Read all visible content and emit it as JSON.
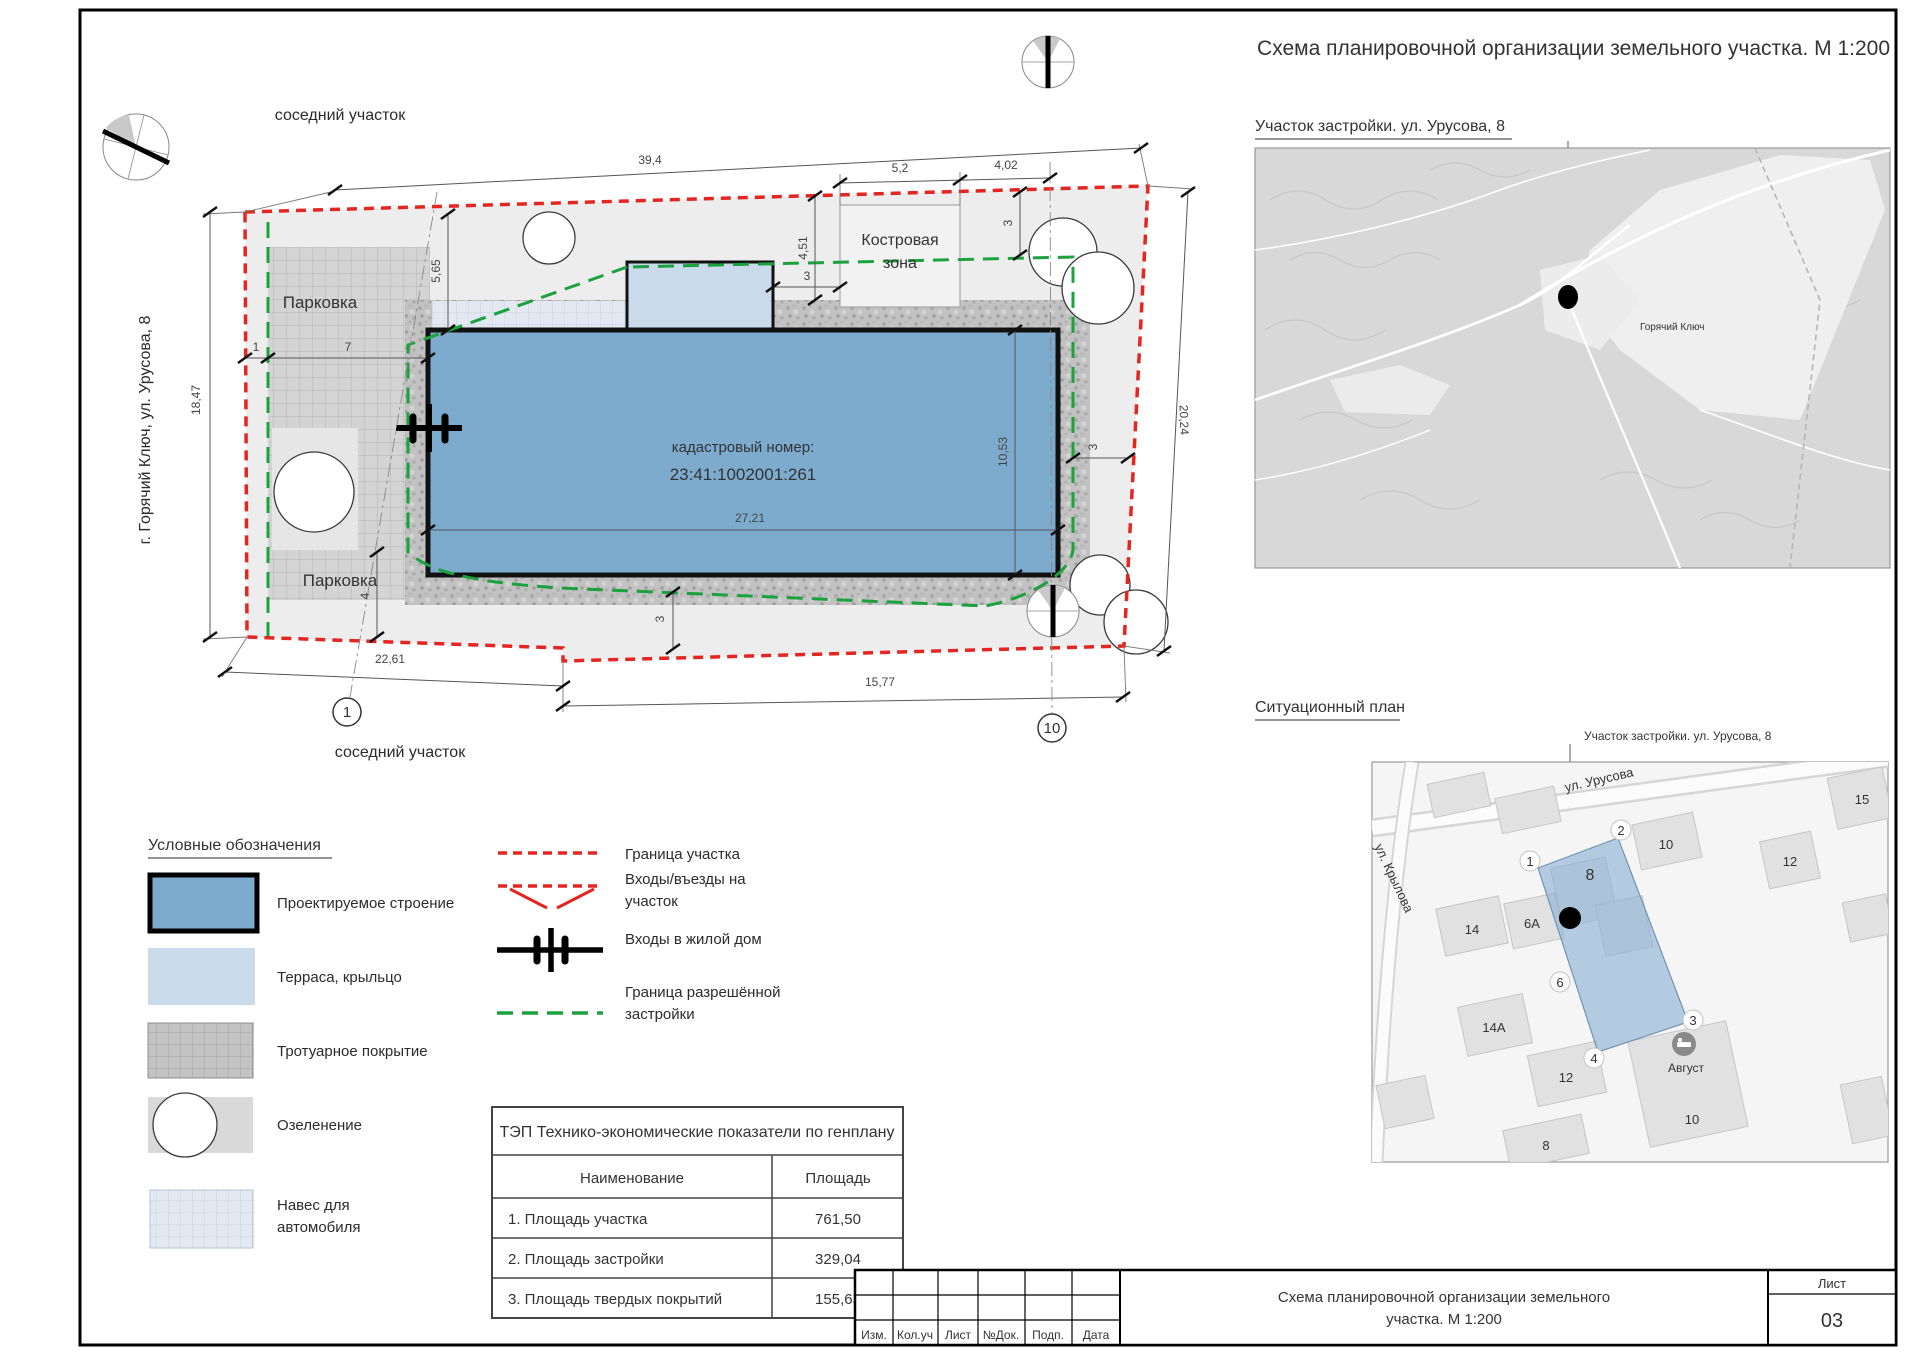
{
  "sheet": {
    "main_title": "Схема планировочной организации земельного участка. М 1:200"
  },
  "site_plan": {
    "neighbor_top": "соседний участок",
    "neighbor_bottom": "соседний участок",
    "street_vertical": "г. Горячий Ключ, ул. Урусова, 8",
    "parking_top": "Парковка",
    "parking_bottom": "Парковка",
    "fire_zone_line1": "Костровая",
    "fire_zone_line2": "зона",
    "cadastral_label": "кадастровый номер:",
    "cadastral_number": "23:41:1002001:261",
    "axis_1": "1",
    "axis_10": "10",
    "dims": {
      "top": "39,4",
      "fire": "5,2",
      "gap": "4,02",
      "right": "20,24",
      "left": "18,47",
      "bottom_left": "22,61",
      "bottom_right": "15,77",
      "bld_w": "27,21",
      "bld_h": "10,53",
      "off565": "5,65",
      "off451": "4,51",
      "t3a": "3",
      "t3b": "3",
      "t3c": "3",
      "t3d": "3",
      "off4": "4",
      "off1": "1",
      "off7": "7"
    }
  },
  "legend": {
    "title": "Условные обозначения",
    "items": [
      {
        "label": "Проектируемое строение"
      },
      {
        "label": "Терраса, крыльцо"
      },
      {
        "label": "Тротуарное покрытие"
      },
      {
        "label": "Озеленение"
      },
      {
        "label1": "Навес для",
        "label2": "автомобиля"
      }
    ],
    "lines": [
      {
        "label": "Граница участка"
      },
      {
        "label1": "Входы/въезды на",
        "label2": "участок"
      },
      {
        "label": "Входы в жилой дом"
      },
      {
        "label1": "Граница разрешённой",
        "label2": "застройки"
      }
    ]
  },
  "tep": {
    "title": "ТЭП Технико-экономические показатели по генплану",
    "col_name": "Наименование",
    "col_area": "Площадь",
    "rows": [
      {
        "name": "1. Площадь участка",
        "value": "761,50"
      },
      {
        "name": "2. Площадь застройки",
        "value": "329,04"
      },
      {
        "name": "3. Площадь твердых покрытий",
        "value": "155,63"
      }
    ]
  },
  "map_region": {
    "title": "Участок застройки. ул. Урусова, 8",
    "city_label": "Горячий Ключ"
  },
  "situational": {
    "title": "Ситуационный план",
    "marker_label": "Участок застройки. ул. Урусова, 8",
    "street1": "ул. Урусова",
    "street2": "ул. Крылова",
    "badges": [
      "1",
      "2",
      "3",
      "4",
      "6"
    ],
    "buildings": {
      "big8": "8",
      "b10a": "10",
      "b12a": "12",
      "b15": "15",
      "b14": "14",
      "b6a": "6А",
      "b14a": "14А",
      "b12b": "12",
      "b10b": "10",
      "b8b": "8",
      "hotel": "Август"
    }
  },
  "title_block": {
    "cols": [
      "Изм.",
      "Кол.уч",
      "Лист",
      "№Док.",
      "Подп.",
      "Дата"
    ],
    "doc_title_line1": "Схема планировочной организации земельного",
    "doc_title_line2": "участка. М 1:200",
    "sheet_label": "Лист",
    "sheet_number": "03"
  }
}
